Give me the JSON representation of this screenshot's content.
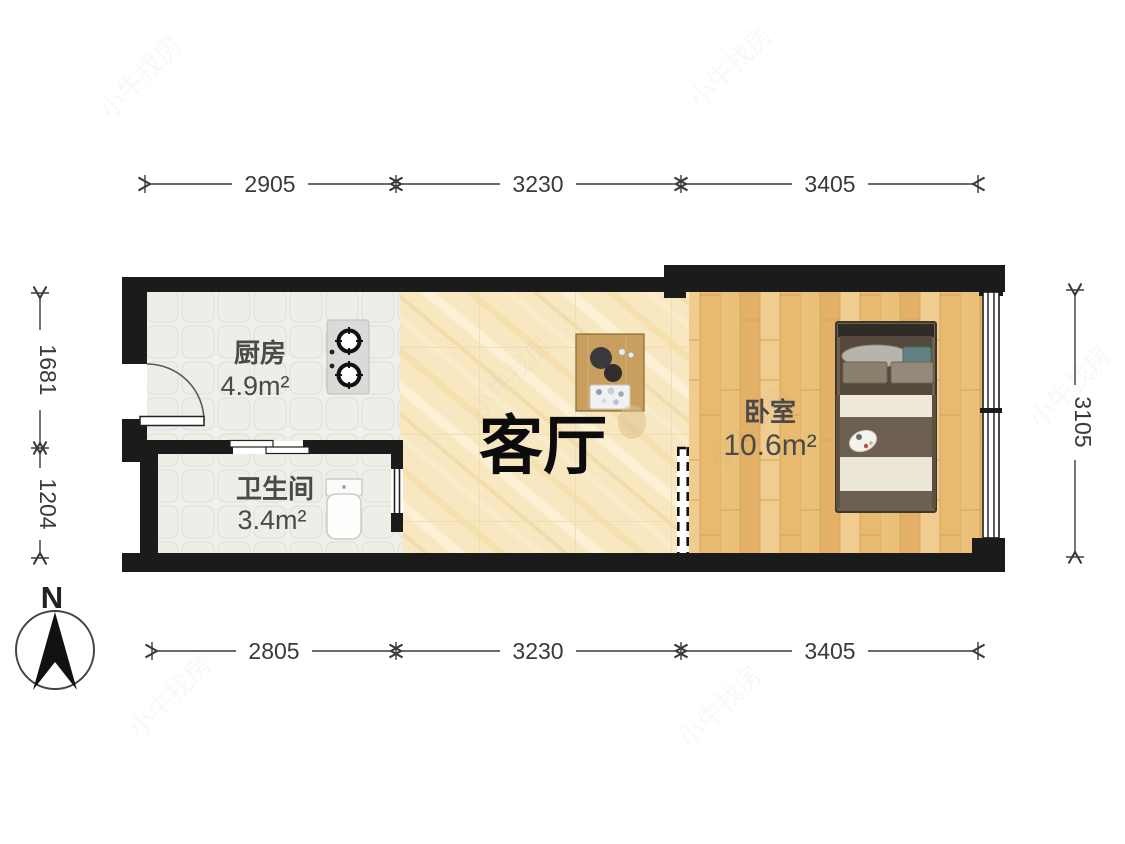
{
  "page": {
    "type": "apartment-floor-plan",
    "background": "#ffffff"
  },
  "compass": {
    "label": "N"
  },
  "rooms": {
    "kitchen": {
      "name": "厨房",
      "area": "4.9m²"
    },
    "bathroom": {
      "name": "卫生间",
      "area": "3.4m²"
    },
    "living": {
      "name": "客厅"
    },
    "bedroom": {
      "name": "卧室",
      "area": "10.6m²"
    }
  },
  "dimensions": {
    "top": [
      "2905",
      "3230",
      "3405"
    ],
    "bottom": [
      "2805",
      "3230",
      "3405"
    ],
    "left": [
      "1681",
      "1204"
    ],
    "right": [
      "3105"
    ]
  },
  "watermark": "小牛找房",
  "colors": {
    "wall": "#1b1b1b",
    "kitchen_floor": "#f0efeb",
    "living_floor": "#f8e8c2",
    "bedroom_floor": "#ecc27e",
    "bed_blanket": "#6e6050",
    "dimension_text": "#3a3a3a"
  }
}
